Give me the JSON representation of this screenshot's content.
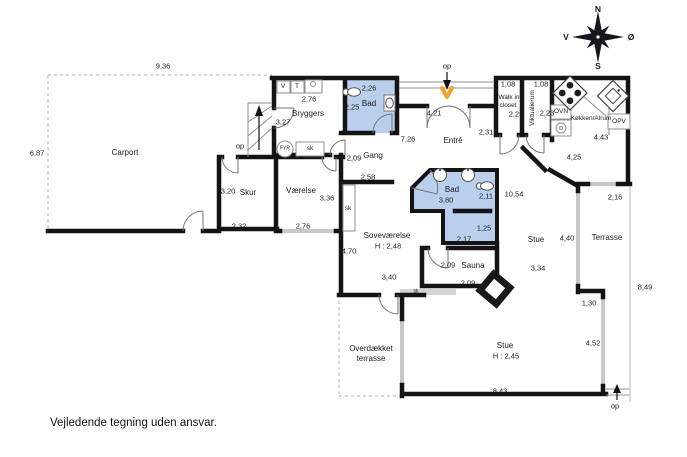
{
  "note": "Vejledende tegning uden ansvar.",
  "compass": {
    "north": "N",
    "south": "S",
    "west": "V",
    "east": "Ø"
  },
  "shared": {
    "stairs_up": "op",
    "closet": "sk"
  },
  "colors": {
    "wall": "#141414",
    "bath_fill": "#b9cfec",
    "window_line": "#c8c8c8",
    "entrance_marker": "#f2a32e",
    "dashed_line": "#bdbdbd"
  },
  "outdoor": {
    "carport": {
      "name": "Carport",
      "width": "9,36",
      "depth": "6,87"
    },
    "overdaekket_terrasse": {
      "line1": "Overdækket",
      "line2": "terrasse"
    },
    "terrasse": {
      "name": "Terrasse",
      "dim_top": "2,16",
      "dim_side": "4,40",
      "dim_step": "1,30",
      "dim_lower": "4,52",
      "dim_total": "8,49"
    }
  },
  "rooms": {
    "skur": {
      "name": "Skur",
      "dim_w": "2,32",
      "dim_h": "3,20"
    },
    "vaerelse": {
      "name": "Værelse",
      "dim_w": "2,76",
      "dim_h": "3,36"
    },
    "bryggers": {
      "name": "Bryggers",
      "dim_w": "2,76",
      "dim_h": "3,27",
      "washer": "V",
      "dryer": "T",
      "boiler": "FYR"
    },
    "bad_nord": {
      "name": "Bad",
      "dim_w": "2,26",
      "dim_h": "2,25"
    },
    "gang": {
      "name": "Gang",
      "dim_w": "2,09",
      "dim_l": "2,58"
    },
    "entre": {
      "name": "Entré",
      "dim_door": "4,21",
      "dim_w": "7,26",
      "dim_e": "2,31"
    },
    "walk_in_closet": {
      "line1": "Walk in",
      "line2": "closet",
      "dim_w": "1,08",
      "dim_h": "2,23"
    },
    "viktualierum": {
      "name": "Viktualierum",
      "dim_w": "1,08",
      "dim_h": "2,23"
    },
    "kokken": {
      "name": "Køkken/Alrum",
      "oven": "OVN",
      "dishwasher": "OPV",
      "dim_a": "4,43",
      "dim_b": "4,25"
    },
    "bad_midt": {
      "name": "Bad",
      "dim_w": "3,80",
      "dim_e": "2,11",
      "dim_s1": "1,25",
      "dim_s2": "2,17"
    },
    "fordelingsgang": {
      "dim": "10,54"
    },
    "sovevaerelse": {
      "name": "Soveværelse",
      "ceiling": "H : 2,48",
      "dim_w": "4,70",
      "dim_s": "3,40"
    },
    "sauna": {
      "name": "Sauna",
      "dim_w": "2,09",
      "dim_s": "2,09"
    },
    "stue": {
      "name": "Stue",
      "dim_a": "4,40",
      "dim_b": "3,34"
    },
    "stue_syd": {
      "name": "Stue",
      "ceiling": "H : 2,45",
      "dim_w": "8,43"
    }
  }
}
